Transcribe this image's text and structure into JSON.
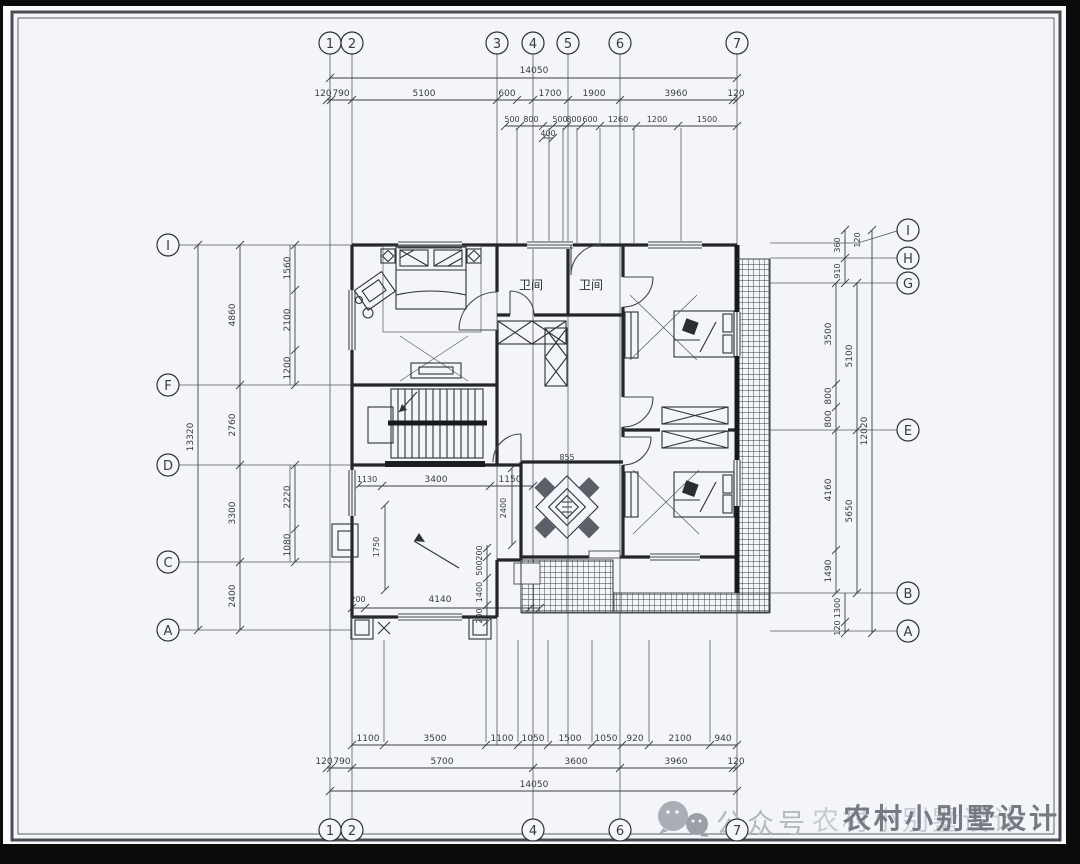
{
  "axes": {
    "top": [
      "1",
      "2",
      "3",
      "4",
      "5",
      "6",
      "7"
    ],
    "bottom": [
      "1",
      "2",
      "4",
      "6",
      "7"
    ],
    "left": [
      "I",
      "F",
      "D",
      "C",
      "A"
    ],
    "right": [
      "I",
      "H",
      "G",
      "E",
      "B",
      "A"
    ]
  },
  "dims": {
    "top_total": "14050",
    "top1": [
      "120",
      "790",
      "5100",
      "600",
      "1700",
      "1900",
      "3960",
      "120"
    ],
    "top2": [
      "500",
      "800",
      "500",
      "800",
      "600",
      "1260",
      "1200",
      "1500"
    ],
    "top2b": "400",
    "bottom1": [
      "1100",
      "3500",
      "1100",
      "1050",
      "1500",
      "1050",
      "920",
      "2100",
      "940"
    ],
    "bottom2": [
      "120",
      "790",
      "5700",
      "3600",
      "3960",
      "120"
    ],
    "bottom_total": "14050",
    "left_total": "13320",
    "left_mid": [
      "4860",
      "2760",
      "3300",
      "2400"
    ],
    "left_inner": [
      "1560",
      "2100",
      "1200",
      "2220",
      "1080"
    ],
    "right_col": [
      "120",
      "360",
      "910",
      "3500",
      "800",
      "800",
      "4160",
      "1490",
      "1300",
      "120"
    ],
    "right_mid": [
      "5100",
      "5650"
    ],
    "right_total": "12020",
    "interior": [
      "1130",
      "3400",
      "1150",
      "2400",
      "1750",
      "4140",
      "200",
      "200",
      "500",
      "1400",
      "200",
      "855"
    ]
  },
  "rooms": {
    "bath1": "卫间",
    "bath2": "卫间"
  },
  "watermark": {
    "account": "公众号",
    "name": "农村小别墅设计"
  }
}
